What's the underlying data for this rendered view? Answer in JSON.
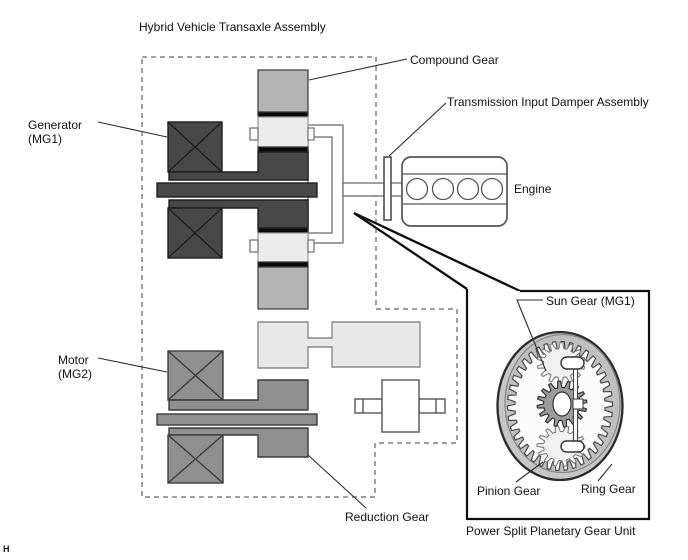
{
  "diagram": {
    "title": "Hybrid Vehicle Transaxle Assembly",
    "labels": {
      "compound_gear": "Compound Gear",
      "damper": "Transmission Input Damper Assembly",
      "engine": "Engine",
      "generator": "Generator",
      "generator_sub": "(MG1)",
      "motor": "Motor",
      "motor_sub": "(MG2)",
      "reduction_gear": "Reduction Gear"
    },
    "inset": {
      "caption": "Power Split Planetary Gear Unit",
      "labels": {
        "sun_gear": "Sun Gear (MG1)",
        "pinion_gear": "Pinion Gear",
        "ring_gear": "Ring Gear"
      }
    },
    "page_marker": "H",
    "colors": {
      "dark_component": "#484848",
      "medium_component": "#8f8f8f",
      "light_block": "#b4b4b4",
      "pale_block": "#ececec",
      "counter_gear": "#e8e8e8",
      "black_band": "#0a0a0a",
      "outline": "#777777",
      "dashed_boundary": "#808080",
      "ring_gear_body": "#c6c6c6",
      "sun_gear_body": "#9c9c9c",
      "pinion_body": "#f1f1f1",
      "leader_line": "#2d2d2d"
    }
  }
}
